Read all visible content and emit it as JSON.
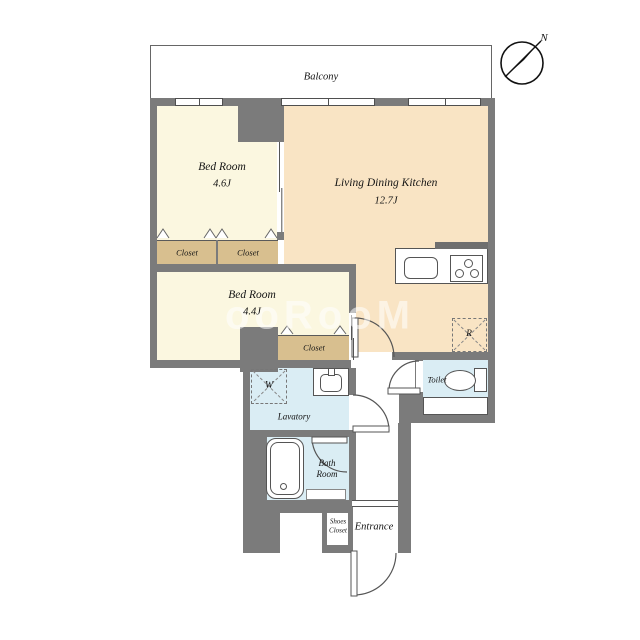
{
  "compass": {
    "north_label": "N"
  },
  "balcony": {
    "label": "Balcony"
  },
  "rooms": {
    "bedroom1": {
      "name": "Bed Room",
      "size": "4.6J"
    },
    "ldk": {
      "name": "Living Dining Kitchen",
      "size": "12.7J"
    },
    "bedroom2": {
      "name": "Bed Room",
      "size": "4.4J"
    },
    "closet_a": {
      "label": "Closet"
    },
    "closet_b": {
      "label": "Closet"
    },
    "closet_c": {
      "label": "Closet"
    },
    "lavatory": {
      "label": "Lavatory"
    },
    "bathroom": {
      "label_line1": "Bath",
      "label_line2": "Room"
    },
    "toilet": {
      "label": "Toilet"
    },
    "shoes_closet": {
      "label_line1": "Shoes",
      "label_line2": "Closet"
    },
    "entrance": {
      "label": "Entrance"
    }
  },
  "appliances": {
    "washer_symbol": "W",
    "refrigerator_symbol": "R"
  },
  "watermark": {
    "text": "ooRooM"
  },
  "colors": {
    "wall": "#7b7b7b",
    "bedroom_fill": "#fbf7e0",
    "ldk_fill": "#f9e4c4",
    "closet_fill": "#d8bf8f",
    "wet_area_fill": "#daedf4",
    "counter_bar": "#6f6f6f",
    "line": "#555555"
  }
}
